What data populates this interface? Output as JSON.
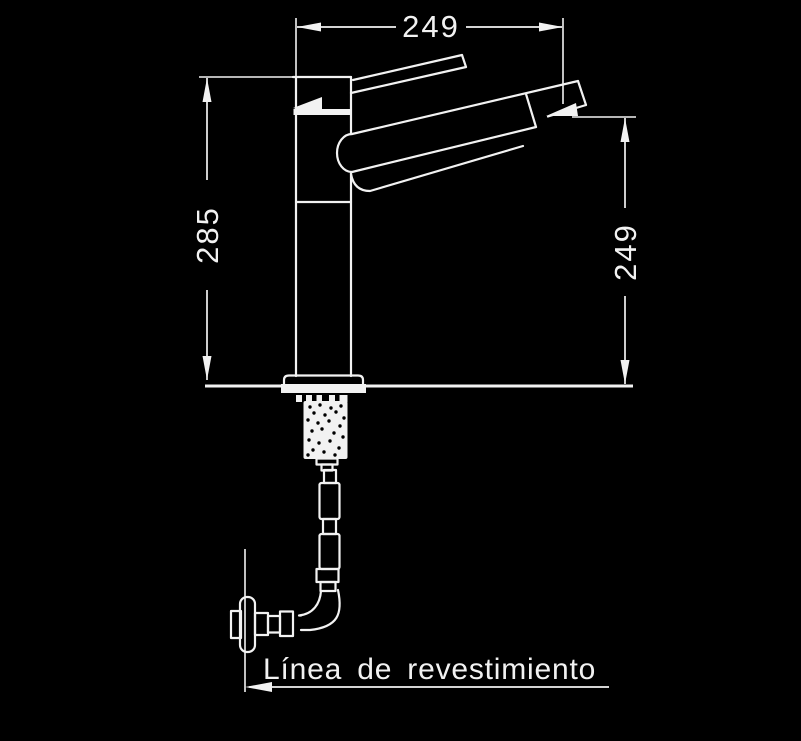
{
  "diagram": {
    "dimensions": {
      "top": {
        "value": "249"
      },
      "left": {
        "value": "285"
      },
      "right": {
        "value": "249"
      }
    },
    "annotation": {
      "covering_line_label": "Línea de revestimiento"
    },
    "colors": {
      "background": "#000000",
      "ink": "#f2f2f2"
    }
  }
}
